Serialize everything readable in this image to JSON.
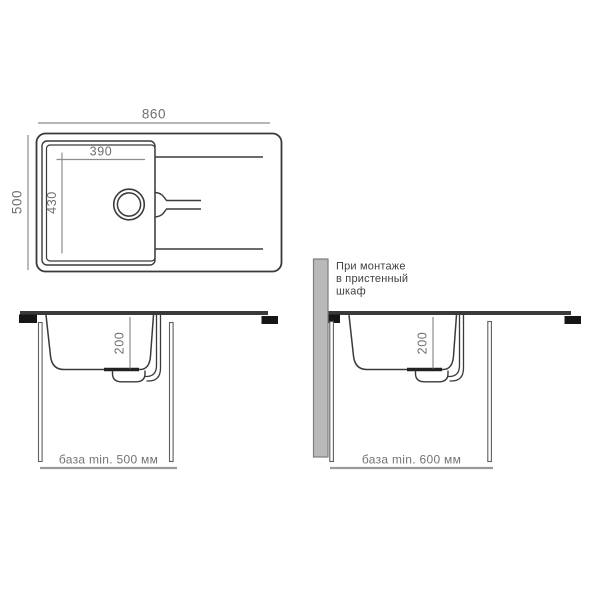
{
  "top_view": {
    "overall_width": "860",
    "overall_depth": "500",
    "bowl_width": "390",
    "bowl_depth": "430"
  },
  "section_standard": {
    "bowl_depth": "200",
    "base_note": "база min. 500 мм"
  },
  "section_wall": {
    "bowl_depth": "200",
    "base_note": "база min. 600 мм",
    "note_lines": [
      "При монтаже",
      "в пристенный",
      "шкаф"
    ]
  },
  "colors": {
    "line_dark": "#3a3a3a",
    "dim_line": "#8c8c8c",
    "dim_text": "#6f6f6f",
    "bracket": "#161616",
    "wall_fill": "#b9b9b9",
    "wall_border": "#7d7d7d",
    "base_line": "#9a9a9a"
  }
}
